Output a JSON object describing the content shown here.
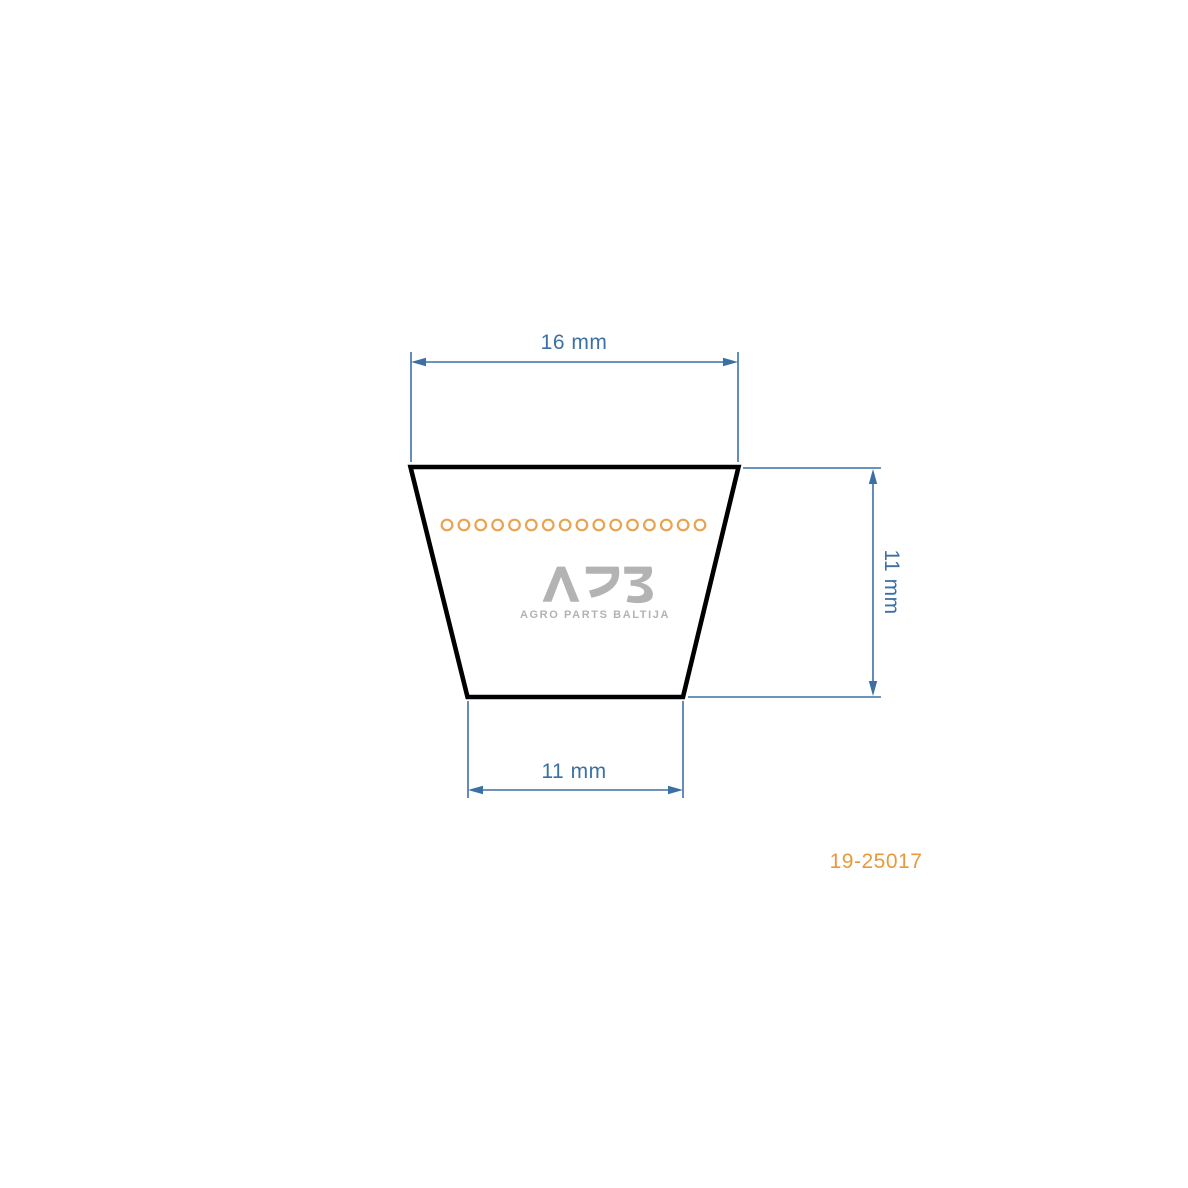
{
  "diagram": {
    "dimensions": {
      "top_width": "16 mm",
      "height": "11 mm",
      "bottom_width": "11 mm"
    },
    "cords": {
      "count": 16
    },
    "watermark": {
      "logo": "APB",
      "subtitle": "AGRO PARTS BALTIJA"
    },
    "part_number": "19-25017",
    "colors": {
      "dimension_blue": "#3c70a4",
      "outline_black": "#000000",
      "cord_orange": "#e9a34f",
      "part_number_orange": "#e8993c",
      "watermark_gray": "#b3b3b3",
      "background": "#ffffff"
    }
  }
}
